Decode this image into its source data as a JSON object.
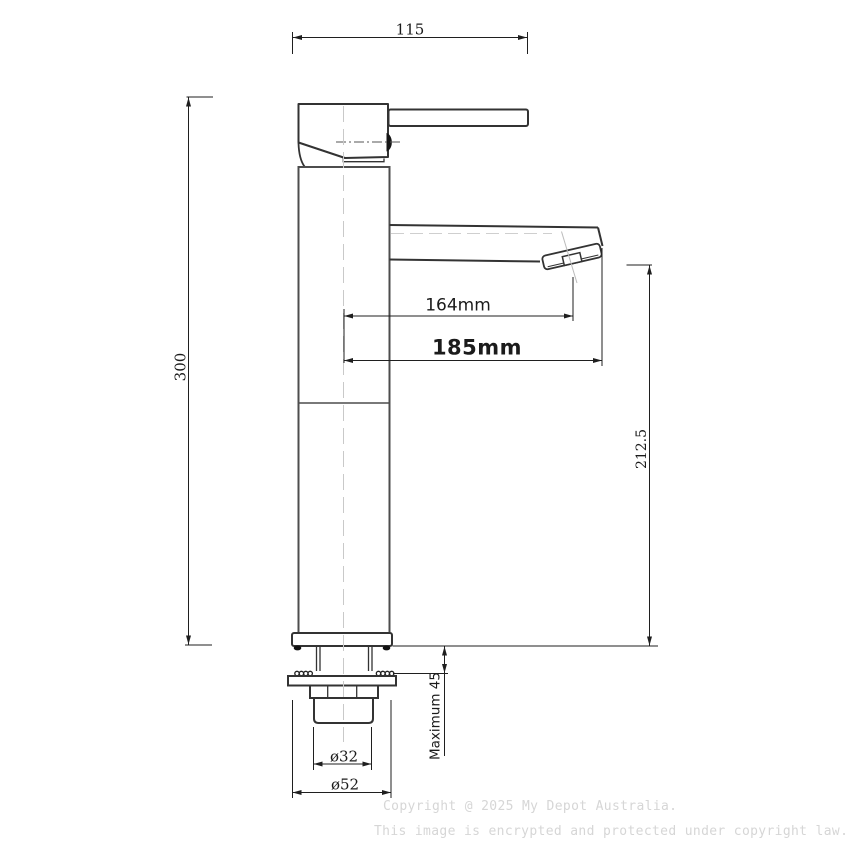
{
  "dimensions": {
    "handle_width": "115",
    "overall_height": "300",
    "spout_reach": "164mm",
    "overall_reach": "185mm",
    "spout_outlet_height": "212.5",
    "max_mounting_thickness": "Maximum 45",
    "thread_diameter": "ø32",
    "base_diameter": "ø52"
  },
  "watermark": {
    "line1": "Copyright @ 2025 My Depot Australia.",
    "line2": "This image is encrypted and protected under copyright law."
  },
  "colors": {
    "background": "#ffffff",
    "outline": "#333333",
    "dimension_line": "#1f1f1f",
    "centerline": "#c9c9c9",
    "watermark": "#d6d6d6"
  }
}
